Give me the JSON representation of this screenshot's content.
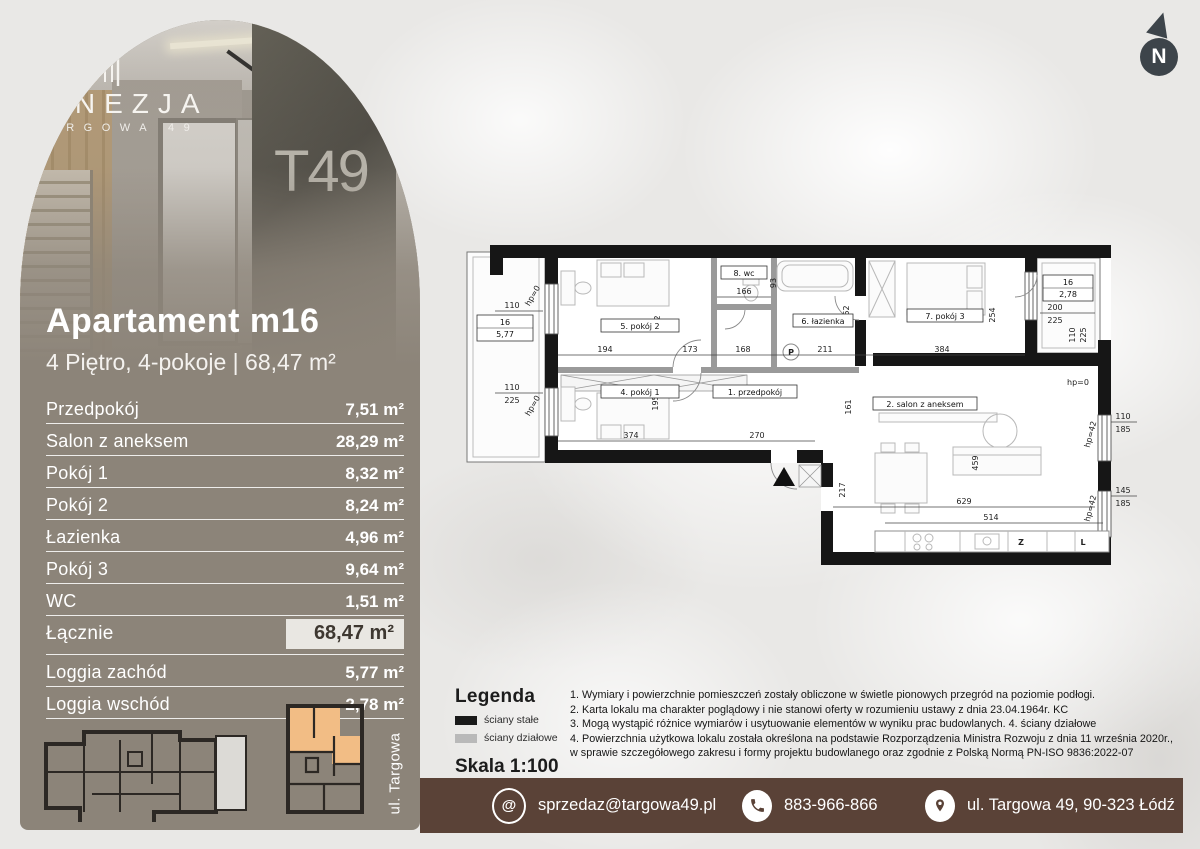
{
  "brand": {
    "name": "FINEZJA",
    "sub": "TARGOWA 49",
    "mural": "T49"
  },
  "north": {
    "label": "N"
  },
  "header": {
    "title": "Apartament m16",
    "subtitle": "4 Piętro, 4-pokoje | 68,47 m²"
  },
  "table": {
    "rows": [
      {
        "name": "Przedpokój",
        "area": "7,51 m²"
      },
      {
        "name": "Salon z aneksem",
        "area": "28,29 m²"
      },
      {
        "name": "Pokój 1",
        "area": "8,32 m²"
      },
      {
        "name": "Pokój 2",
        "area": "8,24 m²"
      },
      {
        "name": "Łazienka",
        "area": "4,96 m²"
      },
      {
        "name": "Pokój 3",
        "area": "9,64 m²"
      },
      {
        "name": "WC",
        "area": "1,51 m²"
      },
      {
        "name": "Łącznie",
        "area": "68,47 m²"
      },
      {
        "name": "Loggia zachód",
        "area": "5,77 m²"
      },
      {
        "name": "Loggia wschód",
        "area": "2,78 m²"
      }
    ]
  },
  "mini": {
    "street": "ul. Targowa"
  },
  "legend": {
    "title": "Legenda",
    "solid_walls": "ściany stałe",
    "partition_walls": "ściany działowe",
    "scale": "Skala 1:100"
  },
  "notes": [
    "1. Wymiary i powierzchnie pomieszczeń zostały obliczone w świetle pionowych przegród na poziomie podłogi.",
    "2. Karta lokalu ma charakter poglądowy i nie stanowi oferty w rozumieniu ustawy z dnia 23.04.1964r. KC",
    "3. Mogą wystąpić różnice wymiarów i usytuowanie elementów w wyniku prac budowlanych. 4. ściany działowe",
    "4. Powierzchnia użytkowa lokalu została określona na podstawie Rozporządzenia Ministra Rozwoju z dnia 11 września 2020r., w sprawie szczegółowego zakresu i formy projektu budowlanego oraz zgodnie z Polską Normą PN-ISO 9836:2022-07"
  ],
  "footer": {
    "email": "sprzedaz@targowa49.pl",
    "phone": "883-966-866",
    "address": "ul. Targowa 49, 90-323 Łódź",
    "email_icon": "@"
  },
  "plan": {
    "rooms": {
      "r1": "1. przedpokój",
      "r2": "2. salon z aneksem",
      "r4": "4. pokój 1",
      "r5": "5. pokój 2",
      "r6": "6. łazienka",
      "r7": "7. pokój 3",
      "r8": "8. wc"
    },
    "loggia_west": {
      "no": "16",
      "area": "5,77"
    },
    "loggia_east": {
      "no": "16",
      "area": "2,78"
    },
    "appliances": {
      "washer": "P",
      "dishwasher": "Z",
      "fridge": "L"
    },
    "annotations": {
      "hp0": "hp=0",
      "hp42": "hp=42"
    },
    "dims": {
      "d110": "110",
      "d225": "225",
      "d185": "185",
      "d145": "145",
      "d200": "200",
      "d194": "194",
      "d173": "173",
      "d168": "168",
      "d211": "211",
      "d166": "166",
      "d93": "93",
      "d252": "252",
      "d195": "195",
      "d374": "374",
      "d270": "270",
      "d161": "161",
      "d384": "384",
      "d254": "254",
      "d629": "629",
      "d514": "514",
      "d459": "459",
      "d217": "217"
    }
  },
  "colors": {
    "panel": "#8c8479",
    "footer": "#5a4237",
    "accent": "#f2bd85",
    "highlight": "#e9e7e2"
  }
}
